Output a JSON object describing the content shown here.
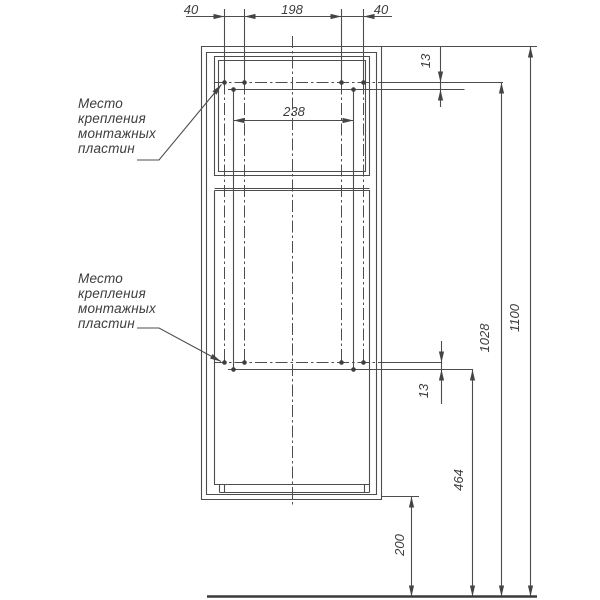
{
  "drawing": {
    "type": "furniture mounting technical drawing",
    "units": "mm",
    "colors": {
      "background": "#ffffff",
      "line": "#4d4d4d",
      "text": "#3d3d3d"
    }
  },
  "notes": {
    "upper": {
      "l1": "Место",
      "l2": "крепления",
      "l3": "монтажных",
      "l4": "пластин"
    },
    "lower": {
      "l1": "Место",
      "l2": "крепления",
      "l3": "монтажных",
      "l4": "пластин"
    }
  },
  "dims": {
    "top_40_left": "40",
    "top_198": "198",
    "top_40_right": "40",
    "plate_238": "238",
    "offset_13_upper": "13",
    "offset_13_lower": "13",
    "h_1028": "1028",
    "h_1100": "1100",
    "h_464": "464",
    "h_200": "200"
  }
}
